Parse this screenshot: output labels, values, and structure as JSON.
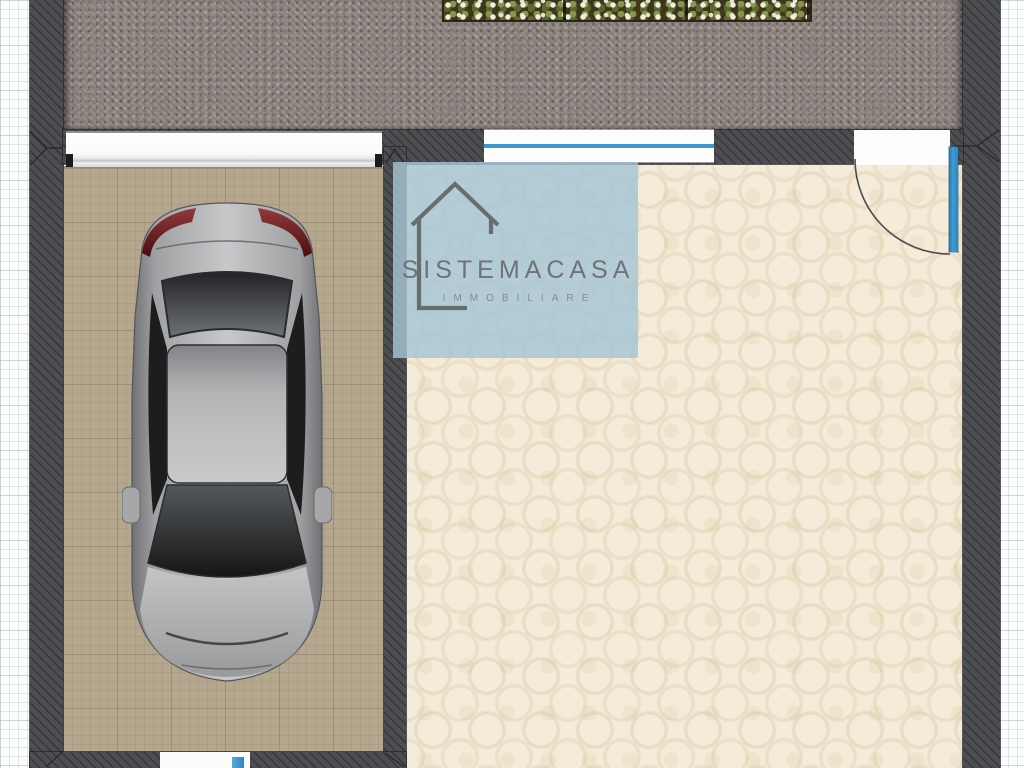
{
  "watermark": {
    "brand": "SISTEMACASA",
    "tagline": "IMMOBILIARE",
    "icon": "house-outline-icon",
    "panel_color": "#a5c4d4"
  },
  "plan": {
    "type": "floor-plan",
    "rooms": [
      {
        "id": "garage",
        "floor": "tan-tile",
        "contents": [
          "car-top-view"
        ]
      },
      {
        "id": "main-room",
        "floor": "cream-ceramic"
      }
    ],
    "openings": [
      {
        "id": "garage-door",
        "wall": "top"
      },
      {
        "id": "window",
        "wall": "top"
      },
      {
        "id": "entry-door",
        "wall": "top-right",
        "swing": "quarter-arc",
        "leaf_color": "#2f8fc6"
      },
      {
        "id": "rear-door",
        "wall": "bottom"
      }
    ],
    "exterior": [
      {
        "id": "paved-terrace"
      },
      {
        "id": "flower-hedge"
      }
    ]
  },
  "colors": {
    "wall": "#4d4e51",
    "accent_blue": "#2f8fc6",
    "paving": "#8f8781",
    "garage_floor": "#b5a78d",
    "room_floor": "#f4ecd9",
    "taillight_red": "#7c2026",
    "grid_line": "#d7dde1"
  }
}
